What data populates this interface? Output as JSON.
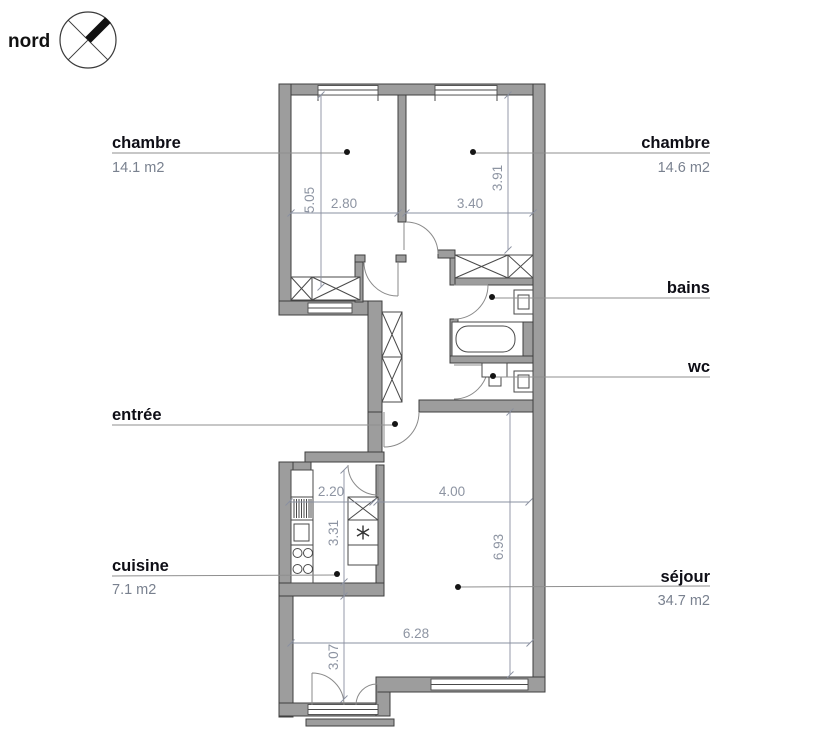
{
  "compass": {
    "label": "nord"
  },
  "rooms": {
    "chambre1": {
      "label": "chambre",
      "area": "14.1 m2"
    },
    "chambre2": {
      "label": "chambre",
      "area": "14.6 m2"
    },
    "bains": {
      "label": "bains"
    },
    "wc": {
      "label": "wc"
    },
    "entree": {
      "label": "entrée"
    },
    "cuisine": {
      "label": "cuisine",
      "area": "7.1 m2"
    },
    "sejour": {
      "label": "séjour",
      "area": "34.7 m2"
    }
  },
  "dimensions": {
    "chambre1_height": "5.05",
    "chambre1_width": "2.80",
    "chambre2_width": "3.40",
    "chambre2_height": "3.91",
    "cuisine_width": "2.20",
    "cuisine_height": "3.31",
    "entree_sejour_width": "4.00",
    "sejour_height": "6.93",
    "sejour_width": "6.28",
    "sejour_balcony_height": "3.07"
  },
  "colors": {
    "wall_fill": "#9d9d9d",
    "wall_edge": "#3f3f3f",
    "dimension_text": "#8d94a2",
    "room_label": "#0e0e16",
    "area_text": "#79818f"
  }
}
